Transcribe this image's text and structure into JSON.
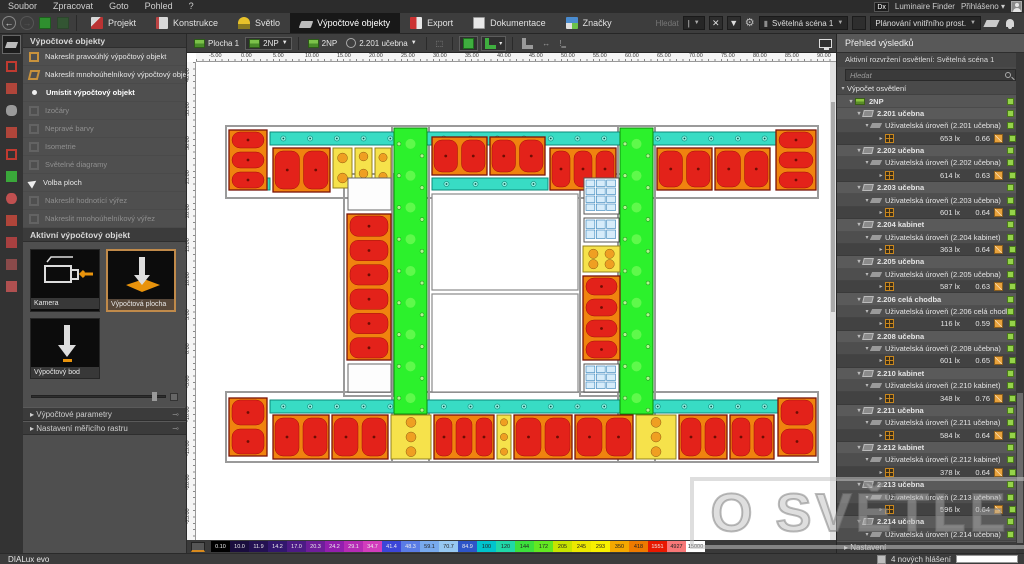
{
  "menu_bar": {
    "items": [
      "Soubor",
      "Zpracovat",
      "Goto",
      "Pohled",
      "?"
    ],
    "right": {
      "badge": "Dx",
      "finder": "Luminaire Finder",
      "account": "Přihlášeno"
    }
  },
  "toolbar": {
    "tabs": [
      {
        "label": "Projekt",
        "icon": "projekt",
        "active": false
      },
      {
        "label": "Konstrukce",
        "icon": "konstrukce",
        "active": false
      },
      {
        "label": "Světlo",
        "icon": "svetlo",
        "active": false
      },
      {
        "label": "Výpočtové objekty",
        "icon": "vypocet",
        "active": true
      },
      {
        "label": "Export",
        "icon": "export",
        "active": false
      },
      {
        "label": "Dokumentace",
        "icon": "dokumentace",
        "active": false
      },
      {
        "label": "Značky",
        "icon": "znacky",
        "active": false
      }
    ],
    "search_label": "Hledat",
    "scene_select": "Světelná scéna 1",
    "mode_select": "Plánování vnitřního prost."
  },
  "left_strip": {
    "icons": [
      {
        "name": "calculation-objects-tool",
        "color": "#bbbbbb",
        "active": true
      },
      {
        "name": "cube-icon",
        "color": "#c03a30",
        "active": false
      },
      {
        "name": "furniture-icon",
        "color": "#b0453a",
        "active": false
      },
      {
        "name": "column-icon",
        "color": "#9a9a9a",
        "active": false
      },
      {
        "name": "opening-icon",
        "color": "#b0453a",
        "active": false
      },
      {
        "name": "room-contour-icon",
        "color": "#c03a30",
        "active": false
      },
      {
        "name": "emergency-sign-icon",
        "color": "#3aa83a",
        "active": false
      },
      {
        "name": "visibility-eye-icon",
        "color": "#c05050",
        "active": false
      },
      {
        "name": "section-icon",
        "color": "#b0453a",
        "active": false
      },
      {
        "name": "wall-icon",
        "color": "#a84040",
        "active": false
      },
      {
        "name": "window-icon",
        "color": "#8a4a4a",
        "active": false
      },
      {
        "name": "raster-icon",
        "color": "#b05050",
        "active": false
      }
    ]
  },
  "tools_panel": {
    "title": "Výpočtové objekty",
    "items": [
      {
        "label": "Nakreslit pravoúhlý výpočtový objekt",
        "icon": "rect",
        "enabled": true,
        "selected": false
      },
      {
        "label": "Nakreslit mnohoúhelníkový výpočtový objekt",
        "icon": "poly",
        "enabled": true,
        "selected": false
      },
      {
        "label": "Umístit výpočtový objekt",
        "icon": "bullet",
        "enabled": true,
        "selected": true
      },
      {
        "label": "Izočáry",
        "icon": "ghost",
        "enabled": false,
        "selected": false
      },
      {
        "label": "Nepravé barvy",
        "icon": "ghost",
        "enabled": false,
        "selected": false
      },
      {
        "label": "Isometrie",
        "icon": "ghost",
        "enabled": false,
        "selected": false
      },
      {
        "label": "Světelné diagramy",
        "icon": "ghost",
        "enabled": false,
        "selected": false
      },
      {
        "label": "Volba ploch",
        "icon": "hand",
        "enabled": true,
        "selected": false
      },
      {
        "label": "Nakreslit hodnotící výřez",
        "icon": "ghost",
        "enabled": false,
        "selected": false
      },
      {
        "label": "Nakreslit mnohoúhelníkový výřez",
        "icon": "ghost",
        "enabled": false,
        "selected": false
      }
    ],
    "active_object_title": "Aktivní výpočtový objekt",
    "tiles": [
      {
        "label": "Kamera",
        "selected": false
      },
      {
        "label": "Výpočtová plocha",
        "selected": true
      },
      {
        "label": "Výpočtový bod",
        "selected": false
      }
    ],
    "sections": [
      "Výpočtové parametry",
      "Nastavení měřicího rastru"
    ]
  },
  "canvas_toolbar": {
    "surface": "Plocha 1",
    "storey_select": "2NP",
    "storey_label": "2NP",
    "room_select": "2.201 učebna"
  },
  "canvas": {
    "ruler_h": [
      "-5.00",
      "0.00",
      "5.00",
      "10.00",
      "15.00",
      "20.00",
      "25.00",
      "30.00",
      "35.00",
      "40.00",
      "45.00",
      "50.00",
      "55.00",
      "60.00",
      "65.00",
      "70.00",
      "75.00",
      "80.00",
      "85.00",
      "90.00"
    ],
    "ruler_v": [
      "40.00",
      "35.00",
      "30.00",
      "25.00",
      "20.00",
      "15.00",
      "10.00",
      "5.00",
      "0.00",
      "-5.00",
      "-10.00",
      "-15.00",
      "-20.00",
      "-25.00"
    ]
  },
  "floorplan": {
    "rooms": [
      {
        "s": "bound",
        "x": 30,
        "y": 64,
        "w": 592,
        "h": 72
      },
      {
        "s": "bound",
        "x": 30,
        "y": 330,
        "w": 592,
        "h": 70
      },
      {
        "s": "bound",
        "x": 196,
        "y": 64,
        "w": 37,
        "h": 336
      },
      {
        "s": "bound",
        "x": 422,
        "y": 64,
        "w": 37,
        "h": 336
      },
      {
        "s": "bound",
        "x": 148,
        "y": 112,
        "w": 50,
        "h": 222
      },
      {
        "s": "bound",
        "x": 384,
        "y": 112,
        "w": 42,
        "h": 222
      },
      {
        "s": "cyan",
        "x": 74,
        "y": 70,
        "w": 508,
        "h": 13
      },
      {
        "s": "cyan",
        "x": 33,
        "y": 116,
        "w": 41,
        "h": 12
      },
      {
        "s": "cyan",
        "x": 236,
        "y": 116,
        "w": 116,
        "h": 12
      },
      {
        "s": "cyan",
        "x": 74,
        "y": 338,
        "w": 508,
        "h": 13
      },
      {
        "s": "green",
        "x": 198,
        "y": 66,
        "w": 33,
        "h": 286
      },
      {
        "s": "green",
        "x": 424,
        "y": 66,
        "w": 33,
        "h": 286
      },
      {
        "s": "red",
        "x": 33,
        "y": 68,
        "w": 38,
        "h": 60
      },
      {
        "s": "red",
        "x": 77,
        "y": 86,
        "w": 57,
        "h": 44
      },
      {
        "s": "yellow",
        "x": 137,
        "y": 86,
        "w": 19,
        "h": 40
      },
      {
        "s": "yellow",
        "x": 159,
        "y": 86,
        "w": 17,
        "h": 34
      },
      {
        "s": "yellow",
        "x": 179,
        "y": 86,
        "w": 16,
        "h": 38
      },
      {
        "s": "red",
        "x": 236,
        "y": 75,
        "w": 55,
        "h": 38
      },
      {
        "s": "red",
        "x": 294,
        "y": 75,
        "w": 55,
        "h": 38
      },
      {
        "s": "red",
        "x": 354,
        "y": 86,
        "w": 66,
        "h": 42
      },
      {
        "s": "red",
        "x": 461,
        "y": 86,
        "w": 55,
        "h": 42
      },
      {
        "s": "red",
        "x": 519,
        "y": 86,
        "w": 55,
        "h": 42
      },
      {
        "s": "red",
        "x": 580,
        "y": 68,
        "w": 40,
        "h": 60
      },
      {
        "s": "white",
        "x": 152,
        "y": 116,
        "w": 43,
        "h": 32
      },
      {
        "s": "red",
        "x": 151,
        "y": 152,
        "w": 44,
        "h": 146
      },
      {
        "s": "white",
        "x": 152,
        "y": 302,
        "w": 43,
        "h": 28
      },
      {
        "s": "outline",
        "x": 236,
        "y": 132,
        "w": 146,
        "h": 96
      },
      {
        "s": "outline",
        "x": 236,
        "y": 232,
        "w": 146,
        "h": 98
      },
      {
        "s": "util",
        "x": 388,
        "y": 116,
        "w": 35,
        "h": 36
      },
      {
        "s": "util",
        "x": 388,
        "y": 156,
        "w": 35,
        "h": 24
      },
      {
        "s": "yellow",
        "x": 387,
        "y": 184,
        "w": 37,
        "h": 26
      },
      {
        "s": "red",
        "x": 387,
        "y": 214,
        "w": 37,
        "h": 84
      },
      {
        "s": "util",
        "x": 388,
        "y": 302,
        "w": 35,
        "h": 28
      },
      {
        "s": "red",
        "x": 33,
        "y": 336,
        "w": 38,
        "h": 58
      },
      {
        "s": "red",
        "x": 77,
        "y": 353,
        "w": 56,
        "h": 44
      },
      {
        "s": "red",
        "x": 136,
        "y": 353,
        "w": 56,
        "h": 44
      },
      {
        "s": "yellow",
        "x": 195,
        "y": 353,
        "w": 40,
        "h": 44
      },
      {
        "s": "red",
        "x": 238,
        "y": 353,
        "w": 60,
        "h": 44
      },
      {
        "s": "yellow",
        "x": 301,
        "y": 353,
        "w": 14,
        "h": 44
      },
      {
        "s": "red",
        "x": 318,
        "y": 353,
        "w": 58,
        "h": 44
      },
      {
        "s": "red",
        "x": 379,
        "y": 353,
        "w": 58,
        "h": 44
      },
      {
        "s": "yellow",
        "x": 440,
        "y": 353,
        "w": 40,
        "h": 44
      },
      {
        "s": "red",
        "x": 483,
        "y": 353,
        "w": 48,
        "h": 44
      },
      {
        "s": "red",
        "x": 534,
        "y": 353,
        "w": 44,
        "h": 44
      },
      {
        "s": "red",
        "x": 582,
        "y": 336,
        "w": 38,
        "h": 58
      }
    ]
  },
  "colorbar": {
    "values": [
      "0.10",
      "10.0",
      "11.9",
      "14.2",
      "17.0",
      "20.3",
      "24.2",
      "29.1",
      "34.7",
      "41.4",
      "48.3",
      "59.1",
      "70.7",
      "84.9",
      "100",
      "120",
      "144",
      "172",
      "205",
      "245",
      "293",
      "350",
      "418",
      "1551",
      "4927",
      "15000"
    ],
    "colors": [
      "#000000",
      "#1a0d3d",
      "#241152",
      "#32176e",
      "#4c1b85",
      "#6e1e9a",
      "#921fae",
      "#b52bb5",
      "#d23dbd",
      "#3c46d8",
      "#5a7ce6",
      "#78aaee",
      "#96c8f2",
      "#2e55c8",
      "#00c4cc",
      "#20d8a8",
      "#3ce03c",
      "#62e822",
      "#c8e400",
      "#ece800",
      "#f8f000",
      "#f4a800",
      "#ee7a00",
      "#e81800",
      "#f87878",
      "#ffffff"
    ]
  },
  "results_panel": {
    "title": "Přehled výsledků",
    "active_layout": "Aktivní rozvržení osvětlení: Světelná scéna 1",
    "search_placeholder": "Hledat",
    "root_label": "Výpočet osvětlení",
    "floor_label": "2NP",
    "rooms": [
      {
        "name": "2.201 učebna",
        "level": "Uživatelská úroveň (2.201 učebna)",
        "lux": "653 lx",
        "u": "0.66"
      },
      {
        "name": "2.202 učebna",
        "level": "Uživatelská úroveň (2.202 učebna)",
        "lux": "614 lx",
        "u": "0.63"
      },
      {
        "name": "2.203 učebna",
        "level": "Uživatelská úroveň (2.203 učebna)",
        "lux": "601 lx",
        "u": "0.64"
      },
      {
        "name": "2.204 kabinet",
        "level": "Uživatelská úroveň (2.204 kabinet)",
        "lux": "363 lx",
        "u": "0.64"
      },
      {
        "name": "2.205 učebna",
        "level": "Uživatelská úroveň (2.205 učebna)",
        "lux": "587 lx",
        "u": "0.63"
      },
      {
        "name": "2.206 celá chodba",
        "level": "Uživatelská úroveň (2.206 celá chodba)",
        "lux": "116 lx",
        "u": "0.59"
      },
      {
        "name": "2.208 učebna",
        "level": "Uživatelská úroveň (2.208 učebna)",
        "lux": "601 lx",
        "u": "0.65"
      },
      {
        "name": "2.210 kabinet",
        "level": "Uživatelská úroveň (2.210 kabinet)",
        "lux": "348 lx",
        "u": "0.76"
      },
      {
        "name": "2.211 učebna",
        "level": "Uživatelská úroveň (2.211 učebna)",
        "lux": "584 lx",
        "u": "0.64"
      },
      {
        "name": "2.212 kabinet",
        "level": "Uživatelská úroveň (2.212 kabinet)",
        "lux": "378 lx",
        "u": "0.64"
      },
      {
        "name": "2.213 učebna",
        "level": "Uživatelská úroveň (2.213 učebna)",
        "lux": "596 lx",
        "u": "0.64"
      },
      {
        "name": "2.214 učebna",
        "level": "Uživatelská úroveň (2.214 učebna)",
        "lux": "",
        "u": ""
      }
    ],
    "bottom_section": "Nastavení"
  },
  "status_bar": {
    "brand": "DIALux evo",
    "messages": "4 nových hlášení"
  },
  "watermark": "O SVĚTLE"
}
